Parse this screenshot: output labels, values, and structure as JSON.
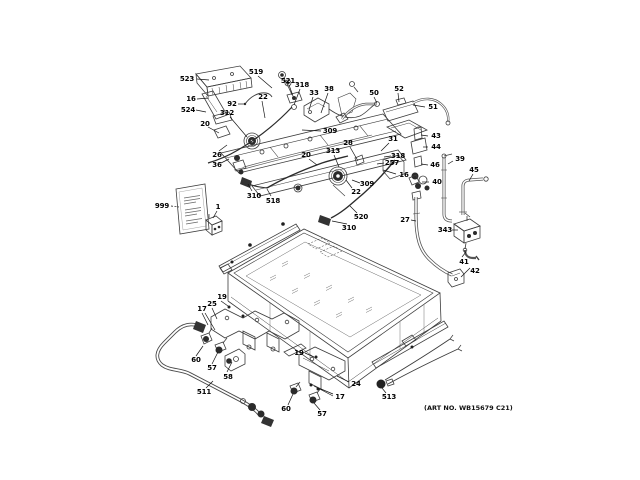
{
  "figure": {
    "type": "exploded-parts-diagram",
    "subject": "gas range burner box and manifold assembly",
    "art_no": "(ART NO. WB15679 C21)"
  },
  "callouts": [
    "523",
    "519",
    "521",
    "318",
    "33",
    "38",
    "16",
    "92",
    "22",
    "524",
    "312",
    "20",
    "50",
    "52",
    "51",
    "309",
    "28",
    "31",
    "43",
    "44",
    "26",
    "20",
    "313",
    "318",
    "257",
    "39",
    "46",
    "36",
    "16",
    "45",
    "40",
    "310",
    "518",
    "999",
    "1",
    "309",
    "22",
    "520",
    "27",
    "310",
    "343",
    "41",
    "42",
    "19",
    "25",
    "17",
    "60",
    "57",
    "58",
    "511",
    "19",
    "24",
    "17",
    "60",
    "57",
    "513"
  ]
}
